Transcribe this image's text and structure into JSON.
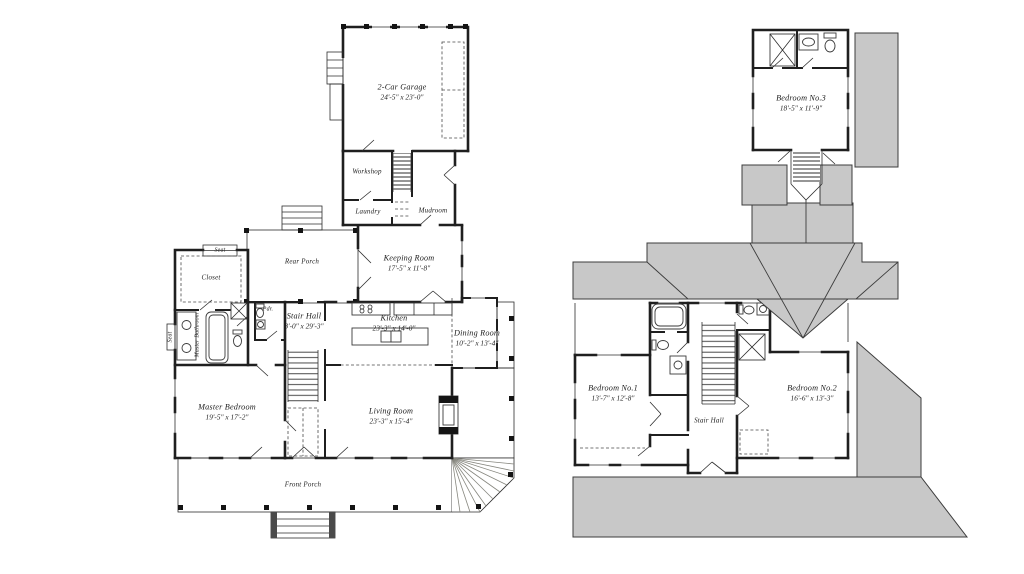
{
  "colors": {
    "background": "#ffffff",
    "roof_fill": "#c8c8c8",
    "wall": "#1f1f1f",
    "label_text": "#1c1c1c"
  },
  "first_floor": {
    "garage": {
      "label": "2-Car Garage",
      "dims": "24'-5\" x 23'-0\""
    },
    "workshop": {
      "label": "Workshop"
    },
    "laundry": {
      "label": "Laundry"
    },
    "mudroom": {
      "label": "Mudroom"
    },
    "rear_porch": {
      "label": "Rear Porch"
    },
    "keeping_room": {
      "label": "Keeping Room",
      "dims": "17'-5\" x 11'-8\""
    },
    "seat_closet": {
      "label": "Seat"
    },
    "closet": {
      "label": "Closet"
    },
    "master_bathroom": {
      "label": "Master Bathroom"
    },
    "seat_bath": {
      "label": "Seat"
    },
    "powder": {
      "label": "Pdr."
    },
    "stair_hall": {
      "label": "Stair Hall",
      "dims": "8'-0\" x 29'-3\""
    },
    "kitchen": {
      "label": "Kitchen",
      "dims": "23'-3\" x 14'-0\""
    },
    "dining_room": {
      "label": "Dining Room",
      "dims": "10'-2\" x 13'-4\""
    },
    "master_bedroom": {
      "label": "Master Bedroom",
      "dims": "19'-5\" x 17'-2\""
    },
    "living_room": {
      "label": "Living Room",
      "dims": "23'-3\" x 15'-4\""
    },
    "front_porch": {
      "label": "Front Porch"
    }
  },
  "second_floor": {
    "bedroom_3": {
      "label": "Bedroom No.3",
      "dims": "18'-5\" x 11'-9\""
    },
    "bedroom_1": {
      "label": "Bedroom No.1",
      "dims": "13'-7\" x 12'-8\""
    },
    "bedroom_2": {
      "label": "Bedroom No.2",
      "dims": "16'-6\" x 13'-3\""
    },
    "stair_hall": {
      "label": "Stair Hall"
    }
  }
}
